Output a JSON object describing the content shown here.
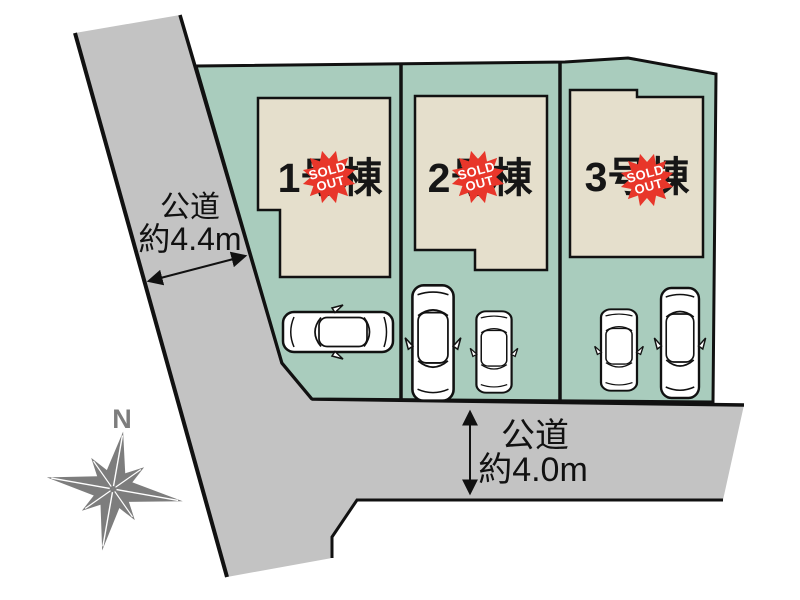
{
  "colors": {
    "road": "#c3c3c3",
    "parcel_green": "#a9ccbd",
    "building": "#e5dfcc",
    "badge_red": "#e8362a",
    "outline": "#111111",
    "compass_gray": "#7d7d7d",
    "text_dark": "#161616"
  },
  "lots": [
    {
      "label": "1号棟",
      "badge": {
        "line1": "SOLD",
        "line2": "OUT"
      }
    },
    {
      "label": "2号棟",
      "badge": {
        "line1": "SOLD",
        "line2": "OUT"
      }
    },
    {
      "label": "3号棟",
      "badge": {
        "line1": "SOLD",
        "line2": "OUT"
      }
    }
  ],
  "roads": {
    "left": {
      "name": "公道",
      "width": "約4.4m"
    },
    "bottom": {
      "name": "公道",
      "width": "約4.0m"
    }
  },
  "compass": {
    "north": "N"
  }
}
